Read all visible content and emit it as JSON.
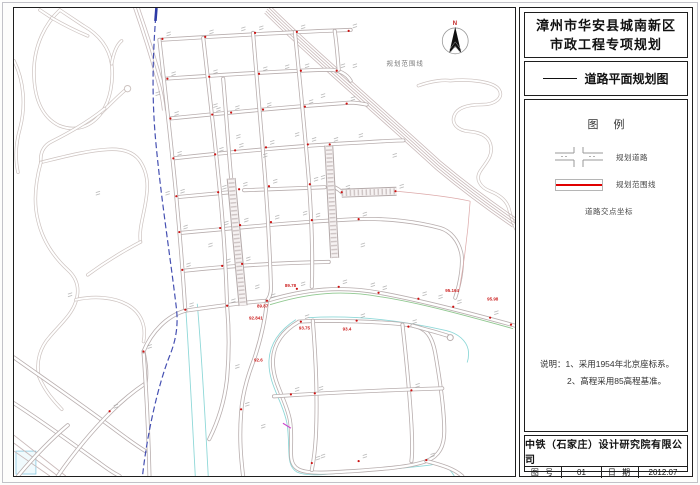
{
  "title_block": {
    "title_line1": "漳州市华安县城南新区",
    "title_line2": "市政工程专项规划",
    "drawing_name": "道路平面规划图",
    "legend_title": "图 例",
    "legend_items": [
      {
        "label": "规划道路"
      },
      {
        "label": "规划范围线"
      },
      {
        "label": "道路交点坐标"
      }
    ],
    "notes": [
      "说明：1、采用1954年北京座标系。",
      "2、高程采用85高程基准。"
    ],
    "company": "中铁（石家庄）设计研究院有限公司",
    "fields": {
      "sheet_no_label": "图 号",
      "sheet_no": "01",
      "date_label": "日 期",
      "date": "2012.07"
    }
  },
  "map": {
    "north_label": "N",
    "boundary_label": "规划范围线",
    "red_labels": [
      {
        "x": 447,
        "y": 292,
        "t": "95.164"
      },
      {
        "x": 489,
        "y": 301,
        "t": "95.98"
      },
      {
        "x": 286,
        "y": 287,
        "t": "89.78"
      },
      {
        "x": 258,
        "y": 308,
        "t": "89.87"
      },
      {
        "x": 250,
        "y": 320,
        "t": "92.841"
      },
      {
        "x": 344,
        "y": 331,
        "t": "93.4"
      },
      {
        "x": 255,
        "y": 362,
        "t": "92.6"
      },
      {
        "x": 300,
        "y": 330,
        "t": "93.75"
      }
    ],
    "colors": {
      "red_line": "#e00000",
      "boundary_blue": "#4550b2",
      "stream_cyan": "#8fd8d8",
      "green_line": "#90c890",
      "dot_red": "#cc1111"
    }
  }
}
